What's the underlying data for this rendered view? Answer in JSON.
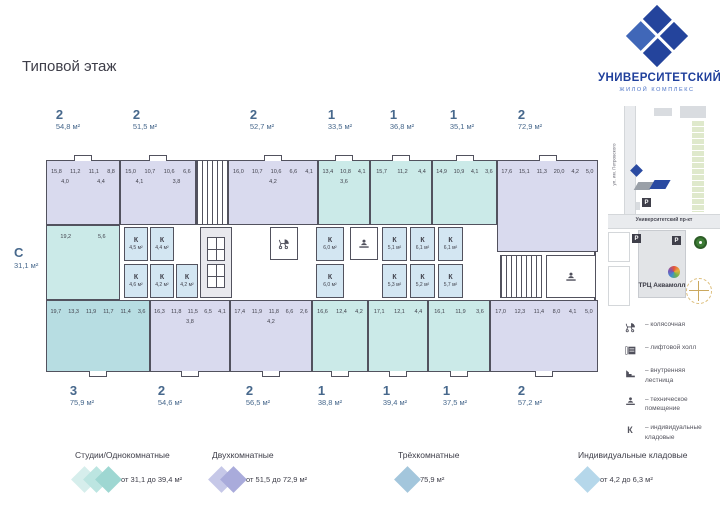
{
  "page": {
    "title": "Типовой этаж"
  },
  "brand": {
    "name": "УНИВЕРСИТЕТСКИЙ",
    "subtitle": "ЖИЛОЙ КОМПЛЕКС",
    "dark": "#24449c",
    "light": "#4067b8"
  },
  "plan": {
    "side_label": {
      "type": "С",
      "area": "31,1 м²"
    },
    "top_apartments": [
      {
        "rooms": "2",
        "area": "54,8 м²",
        "lx": 38,
        "x": 16,
        "w": 74,
        "h": 65,
        "color": "two",
        "cells": [
          "15,8",
          "11,2",
          "11,1",
          "8,8",
          "4,0",
          "4,4"
        ]
      },
      {
        "rooms": "2",
        "area": "51,5 м²",
        "lx": 115,
        "x": 90,
        "w": 76,
        "h": 65,
        "color": "two",
        "cells": [
          "15,0",
          "10,7",
          "10,6",
          "6,6",
          "4,1",
          "3,8"
        ]
      },
      {
        "rooms": "2",
        "area": "52,7 м²",
        "lx": 232,
        "x": 198,
        "w": 90,
        "h": 65,
        "color": "two",
        "cells": [
          "16,0",
          "10,7",
          "10,6",
          "6,6",
          "4,1",
          "4,2"
        ]
      },
      {
        "rooms": "1",
        "area": "33,5 м²",
        "lx": 310,
        "x": 288,
        "w": 52,
        "h": 65,
        "color": "one",
        "cells": [
          "13,4",
          "10,8",
          "4,1",
          "3,6"
        ]
      },
      {
        "rooms": "1",
        "area": "36,8 м²",
        "lx": 372,
        "x": 340,
        "w": 62,
        "h": 65,
        "color": "one",
        "cells": [
          "15,7",
          "11,2",
          "4,4"
        ]
      },
      {
        "rooms": "1",
        "area": "35,1 м²",
        "lx": 432,
        "x": 402,
        "w": 65,
        "h": 65,
        "color": "one",
        "cells": [
          "14,9",
          "10,9",
          "4,1",
          "3,6"
        ]
      },
      {
        "rooms": "2",
        "area": "72,9 м²",
        "lx": 500,
        "x": 467,
        "w": 101,
        "h": 92,
        "color": "two",
        "cells": [
          "17,6",
          "15,1",
          "11,3",
          "20,0",
          "4,2",
          "5,0"
        ]
      }
    ],
    "bottom_apartments": [
      {
        "rooms": "3",
        "area": "75,9 м²",
        "lx": 52,
        "x": 16,
        "w": 104,
        "h": 72,
        "color": "three",
        "cells": [
          "19,7",
          "13,3",
          "11,9",
          "11,7",
          "11,4",
          "3,6"
        ]
      },
      {
        "rooms": "2",
        "area": "54,6 м²",
        "lx": 140,
        "x": 120,
        "w": 80,
        "h": 72,
        "color": "two",
        "cells": [
          "16,3",
          "11,8",
          "11,5",
          "6,5",
          "4,1",
          "3,8"
        ]
      },
      {
        "rooms": "2",
        "area": "56,5 м²",
        "lx": 228,
        "x": 200,
        "w": 82,
        "h": 72,
        "color": "two",
        "cells": [
          "17,4",
          "11,9",
          "11,8",
          "6,6",
          "2,6",
          "4,2"
        ]
      },
      {
        "rooms": "1",
        "area": "38,8 м²",
        "lx": 300,
        "x": 282,
        "w": 56,
        "h": 72,
        "color": "one",
        "cells": [
          "16,6",
          "12,4",
          "4,2"
        ]
      },
      {
        "rooms": "1",
        "area": "39,4 м²",
        "lx": 365,
        "x": 338,
        "w": 60,
        "h": 72,
        "color": "one",
        "cells": [
          "17,1",
          "12,1",
          "4,4"
        ]
      },
      {
        "rooms": "1",
        "area": "37,5 м²",
        "lx": 425,
        "x": 398,
        "w": 62,
        "h": 72,
        "color": "one",
        "cells": [
          "16,1",
          "11,9",
          "3,6"
        ]
      },
      {
        "rooms": "2",
        "area": "57,2 м²",
        "lx": 500,
        "x": 460,
        "w": 108,
        "h": 72,
        "color": "two",
        "cells": [
          "17,0",
          "12,3",
          "11,4",
          "8,0",
          "4,1",
          "5,0"
        ]
      }
    ],
    "studio": {
      "x": 16,
      "y": 65,
      "w": 74,
      "h": 75,
      "color": "one",
      "cells": [
        "19,2",
        "5,6"
      ]
    },
    "storages": [
      {
        "x": 94,
        "y": 67,
        "w": 24,
        "h": 34,
        "k": "К",
        "a": "4,5 м²"
      },
      {
        "x": 120,
        "y": 67,
        "w": 24,
        "h": 34,
        "k": "К",
        "a": "4,4 м²"
      },
      {
        "x": 94,
        "y": 104,
        "w": 24,
        "h": 34,
        "k": "К",
        "a": "4,6 м²"
      },
      {
        "x": 120,
        "y": 104,
        "w": 24,
        "h": 34,
        "k": "К",
        "a": "4,2 м²"
      },
      {
        "x": 146,
        "y": 104,
        "w": 22,
        "h": 34,
        "k": "К",
        "a": "4,2 м²"
      },
      {
        "x": 286,
        "y": 67,
        "w": 28,
        "h": 34,
        "k": "К",
        "a": "6,0 м²"
      },
      {
        "x": 286,
        "y": 104,
        "w": 28,
        "h": 34,
        "k": "К",
        "a": "6,0 м²"
      },
      {
        "x": 352,
        "y": 67,
        "w": 25,
        "h": 34,
        "k": "К",
        "a": "5,1 м²"
      },
      {
        "x": 352,
        "y": 104,
        "w": 25,
        "h": 34,
        "k": "К",
        "a": "5,3 м²"
      },
      {
        "x": 380,
        "y": 67,
        "w": 25,
        "h": 34,
        "k": "К",
        "a": "6,1 м²"
      },
      {
        "x": 380,
        "y": 104,
        "w": 25,
        "h": 34,
        "k": "К",
        "a": "5,2 м²"
      },
      {
        "x": 408,
        "y": 67,
        "w": 25,
        "h": 34,
        "k": "К",
        "a": "6,1 м²"
      },
      {
        "x": 408,
        "y": 104,
        "w": 25,
        "h": 34,
        "k": "К",
        "a": "5,7 м²"
      }
    ],
    "facilities": [
      {
        "type": "entry",
        "x": 166,
        "y": 0,
        "w": 32,
        "h": 65
      },
      {
        "type": "lifts",
        "x": 170,
        "y": 67,
        "w": 32,
        "h": 71
      },
      {
        "type": "stroller",
        "x": 240,
        "y": 67,
        "w": 28,
        "h": 33
      },
      {
        "type": "tech",
        "x": 320,
        "y": 67,
        "w": 28,
        "h": 33
      },
      {
        "type": "stairs",
        "x": 470,
        "y": 95,
        "w": 42,
        "h": 43
      },
      {
        "type": "tech",
        "x": 516,
        "y": 95,
        "w": 50,
        "h": 43
      }
    ]
  },
  "map": {
    "street_v": "ул. им. Петровского",
    "street_h": "Университетский пр-кт",
    "mall": "ТРЦ Аквамолл",
    "parking": "P"
  },
  "rlegend": {
    "items": [
      {
        "icon": "stroller",
        "text": "– колясочная"
      },
      {
        "icon": "elevator",
        "text": "– лифтовой холл"
      },
      {
        "icon": "stairs",
        "text": "– внутренняя лестница"
      },
      {
        "icon": "tech",
        "text": "– техническое помещение"
      },
      {
        "icon": "K",
        "k": "К",
        "text": "– индивидуальные кладовые"
      }
    ]
  },
  "blegend": {
    "items": [
      {
        "x": 75,
        "title": "Студии/Однокомнатные",
        "range": "от 31,1 до 39,4 м²",
        "diamonds": [
          "#d6eeec",
          "#bce5e1",
          "#9ed7d2"
        ]
      },
      {
        "x": 212,
        "title": "Двухкомнатные",
        "range": "от 51,5 до 72,9 м²",
        "diamonds": [
          "#c6c8e8",
          "#a9abdb"
        ]
      },
      {
        "x": 398,
        "title": "Трёхкомнатные",
        "range": "75,9 м²",
        "diamonds": [
          "#a3c6dc"
        ]
      },
      {
        "x": 578,
        "title": "Индивидуальные кладовые",
        "range": "от 4,2 до 6,3 м²",
        "diamonds": [
          "#b5d7ea"
        ]
      }
    ]
  }
}
